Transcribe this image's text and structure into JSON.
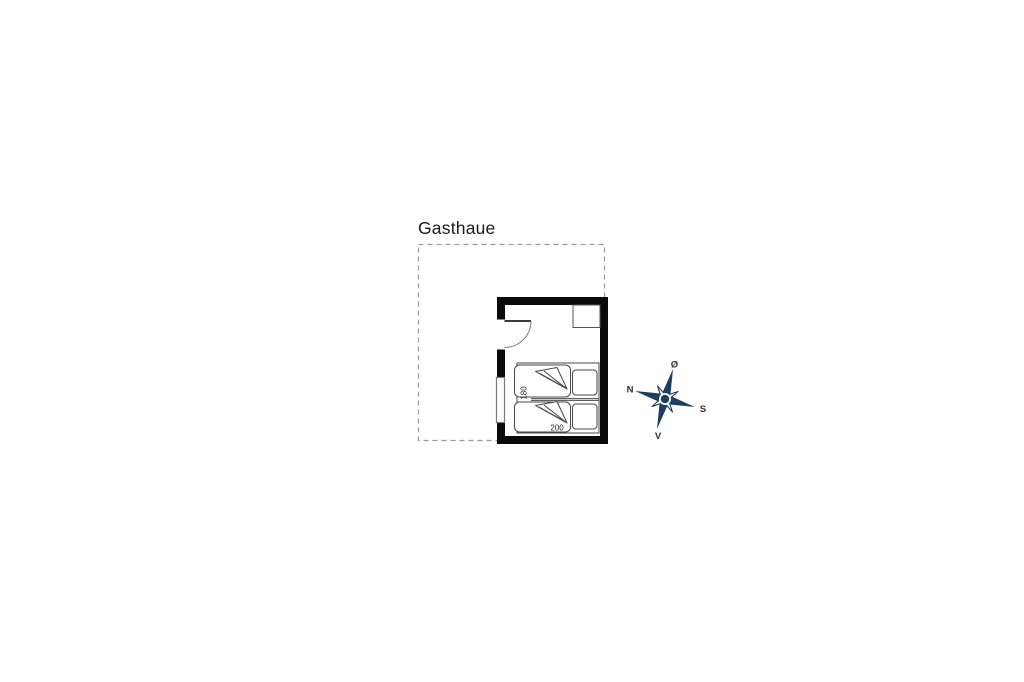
{
  "floorplan": {
    "title": "Gasthaue",
    "bed": {
      "width_label": "180",
      "length_label": "200"
    },
    "colors": {
      "wall": "#0a0a0a",
      "furniture_line": "#474747",
      "boundary_dash": "#9a9a9a"
    }
  },
  "compass": {
    "labels": {
      "north": "N",
      "east": "Ø",
      "south": "S",
      "west": "V"
    },
    "colors": {
      "primary": "#1c3e61",
      "secondary": "#ffffff",
      "label": "#333333"
    }
  }
}
